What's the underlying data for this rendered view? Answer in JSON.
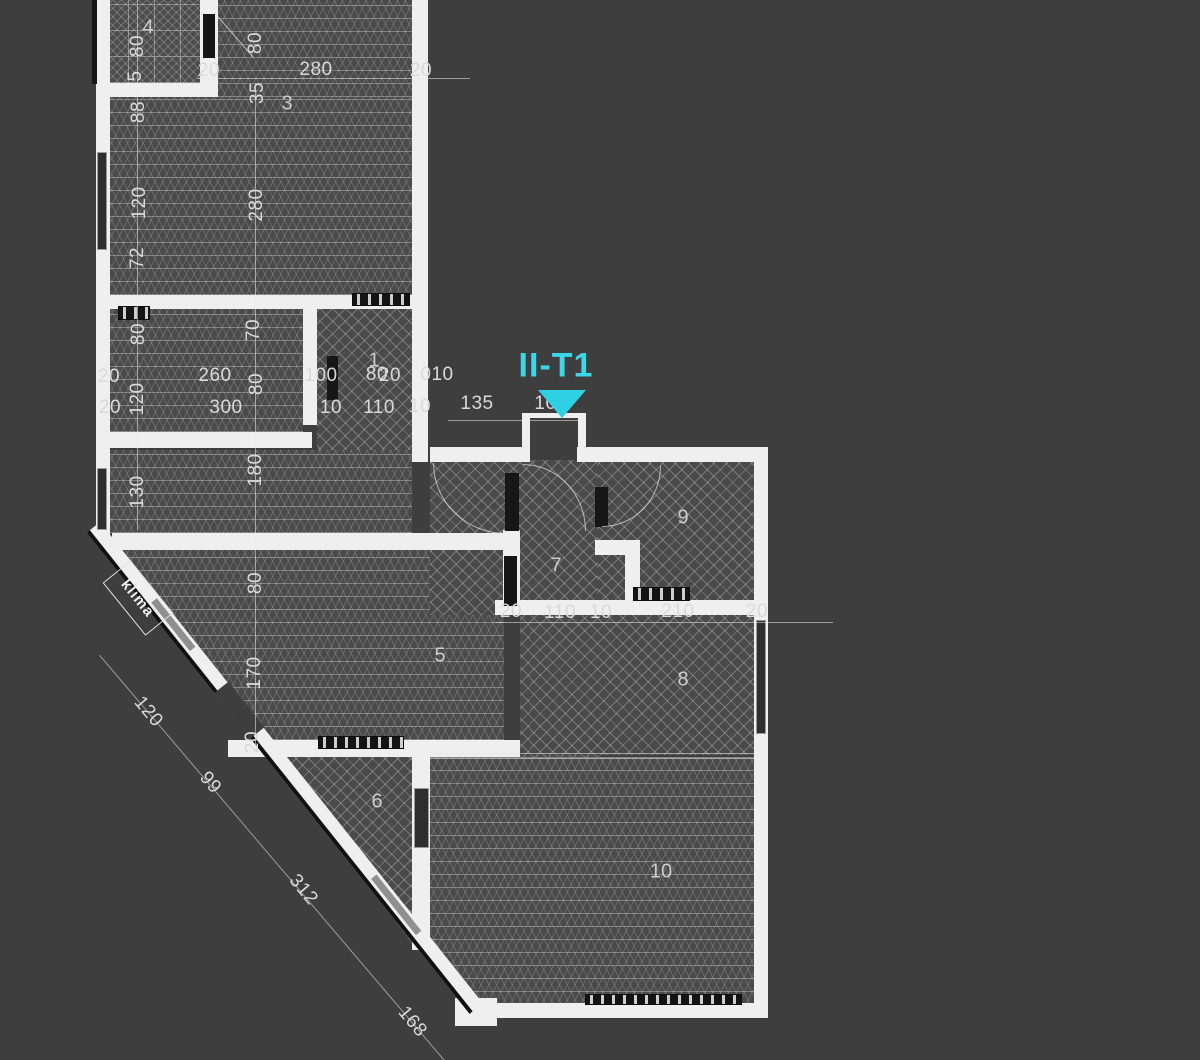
{
  "marker": {
    "label": "II-T1"
  },
  "annotations": {
    "klima": "klima"
  },
  "room_numbers": [
    "4",
    "3",
    "1",
    "5",
    "6",
    "7",
    "8",
    "9",
    "10"
  ],
  "dims_top": [
    "20",
    "280",
    "20"
  ],
  "dims_left_col": [
    "80",
    "5",
    "88",
    "120",
    "72",
    "80",
    "120",
    "130"
  ],
  "dims_left_edge": [
    "20",
    "20"
  ],
  "dims_mid_col": [
    "80",
    "35",
    "280",
    "70",
    "80",
    "180",
    "80",
    "170",
    "20"
  ],
  "dims_mid": [
    "260",
    "300",
    "100",
    "10",
    "80",
    "20",
    "110",
    "010",
    "10",
    "135",
    "100"
  ],
  "dims_lower": [
    "20",
    "110",
    "10",
    "210",
    "20"
  ],
  "dims_diagonal": [
    "120",
    "99",
    "312",
    "168"
  ],
  "colors": {
    "canvas_bg": "#3e3e3e",
    "floor": "#4a4a4a",
    "wall": "#efefef",
    "wall_dark": "#161616",
    "dim_text": "#dadada",
    "marker_cyan": "#3bd7e9"
  }
}
